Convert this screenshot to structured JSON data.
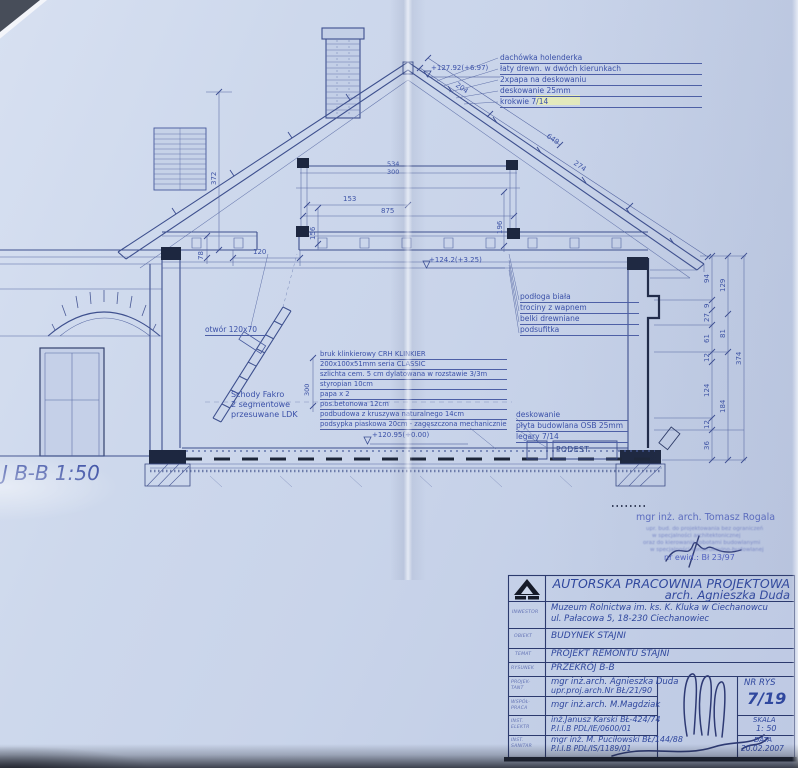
{
  "colors": {
    "paper": "#cbd6ea",
    "line_blue": "#44569a",
    "text_blue": "#3a50a4",
    "dark_navy": "#1d2740",
    "highlight_yellow": "#e9edb4"
  },
  "drawing": {
    "section_label": "J B-B 1:50",
    "roof_notes": [
      "dachówka holenderka",
      "łaty drewn. w dwóch kierunkach",
      "2xpapa na deskowaniu",
      "deskowanie 25mm",
      "krokwie 7/14"
    ],
    "ceiling_notes": [
      "podłoga biała",
      "trociny z wapnem",
      "belki drewniane",
      "podsufitka"
    ],
    "floor_notes": [
      "bruk klinkierowy CRH KLINKIER",
      "200x100x51mm seria CLASSIC",
      "szlichta cem. 5 cm dylatowana w rozstawie 3/3m",
      "styropian 10cm",
      "papa x 2",
      "pos.betonowa 12cm",
      "podbudowa z kruszywa naturalnego 14cm",
      "podsypka piaskowa 20cm - zagęszczona mechanicznie"
    ],
    "deck_notes": [
      "deskowanie",
      "płyta budowlana OSB 25mm",
      "legary 7/14"
    ],
    "stairs_notes": [
      "Schody Fakro",
      "2 segmentowe",
      "przesuwane LDK"
    ],
    "opening_label": "otwór 120x70",
    "podest_label": "PODEST",
    "elevations": {
      "ridge": "+127.92(+6.97)",
      "attic": "+124.2(+3.25)",
      "ground": "+120.95(+0.00)"
    },
    "dims": {
      "collar_a": "534",
      "collar_b": "300",
      "attic_width": "875",
      "post_height": "196",
      "mid_span": "153",
      "mid_height": "156",
      "knee_span": "120",
      "knee_height": "78",
      "left_height": "372",
      "roof_upper": "204",
      "roof_full": "649",
      "roof_mid": "274",
      "floor_height": "300",
      "chain1": [
        "94",
        "9",
        "27",
        "61",
        "12",
        "124",
        "12",
        "36"
      ],
      "chain2": [
        "129",
        "81",
        "184"
      ],
      "chain3": "374"
    }
  },
  "stamp": {
    "name": "mgr inż. arch. Tomasz Rogala",
    "blurred_lines": [
      "upr. bud. do projektowania bez ograniczeń",
      "w specjalności architektonicznej",
      "oraz do kierowania robotami budowlanymi",
      "w specjalności konstrukcyjno-budowlanej"
    ],
    "ewid": "nr ewid.: Bł 23/97"
  },
  "title_block": {
    "company": "AUTORSKA PRACOWNIA PROJEKTOWA",
    "architect": "arch. Agnieszka Duda",
    "inwestor_label": "INWESTOR",
    "inwestor_line1": "Muzeum Rolnictwa im. ks. K. Kluka w Ciechanowcu",
    "inwestor_line2": "ul. Pałacowa 5, 18-230 Ciechanowiec",
    "obiekt_label": "OBIEKT",
    "obiekt": "BUDYNEK STAJNI",
    "temat_label": "TEMAT",
    "temat": "PROJEKT REMONTU STAJNI",
    "rysunek_label": "RYSUNEK",
    "rysunek": "PRZEKRÓJ B-B",
    "projektant_label": "PROJEK- TANT",
    "projektant_line1": "mgr inż.arch. Agnieszka Duda",
    "projektant_line2": "upr.proj.arch.Nr BŁ/21/90",
    "wspolpraca_label": "WSPÓŁ- PRACA",
    "wspolpraca": "mgr inż.arch. M.Magdziak",
    "elektr_label": "INST. ELEKTR",
    "elektr_line1": "inż.Janusz Karski BŁ-424/74",
    "elektr_line2": "P.I.I.B PDL/IE/0600/01",
    "sanitar_label": "INST. SANITAR",
    "sanitar_line1": "mgr inż. M. Puciłowski BŁ/144/88",
    "sanitar_line2": "P.I.I.B PDL/IS/1189/01",
    "nr_rys_label": "NR RYS",
    "nr_rys": "7/19",
    "skala_label": "SKALA",
    "skala": "1: 50",
    "data_label": "DATA",
    "data": "20.02.2007"
  }
}
